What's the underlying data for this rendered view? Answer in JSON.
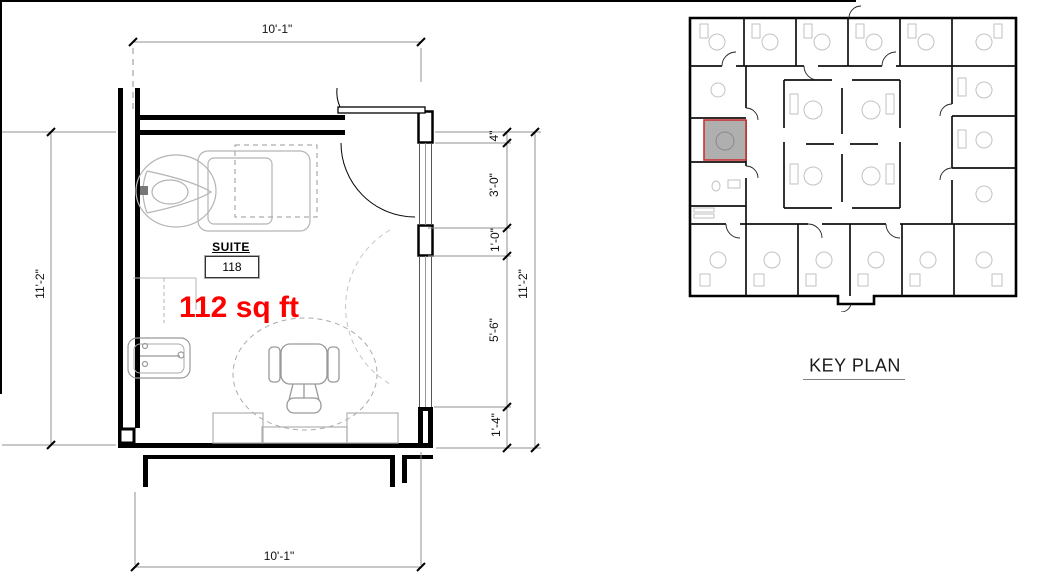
{
  "drawing": {
    "suite_label": "SUITE",
    "suite_number": "118",
    "area_text": "112 sq ft",
    "key_plan_label": "KEY PLAN"
  },
  "dimensions": {
    "top": "10'-1\"",
    "bottom": "10'-1\"",
    "left": "11'-2\"",
    "right_overall": "11'-2\"",
    "right_chain": [
      "4\"",
      "3'-0\"",
      "1'-0\"",
      "5'-6\"",
      "1'-4\""
    ]
  },
  "colors": {
    "area_text": "#ff0000",
    "wall": "#000000",
    "dimension_line": "#909090",
    "furniture_line": "#b4b4b4",
    "highlight_fill": "#a8a8a8",
    "highlight_border": "#c93434"
  }
}
